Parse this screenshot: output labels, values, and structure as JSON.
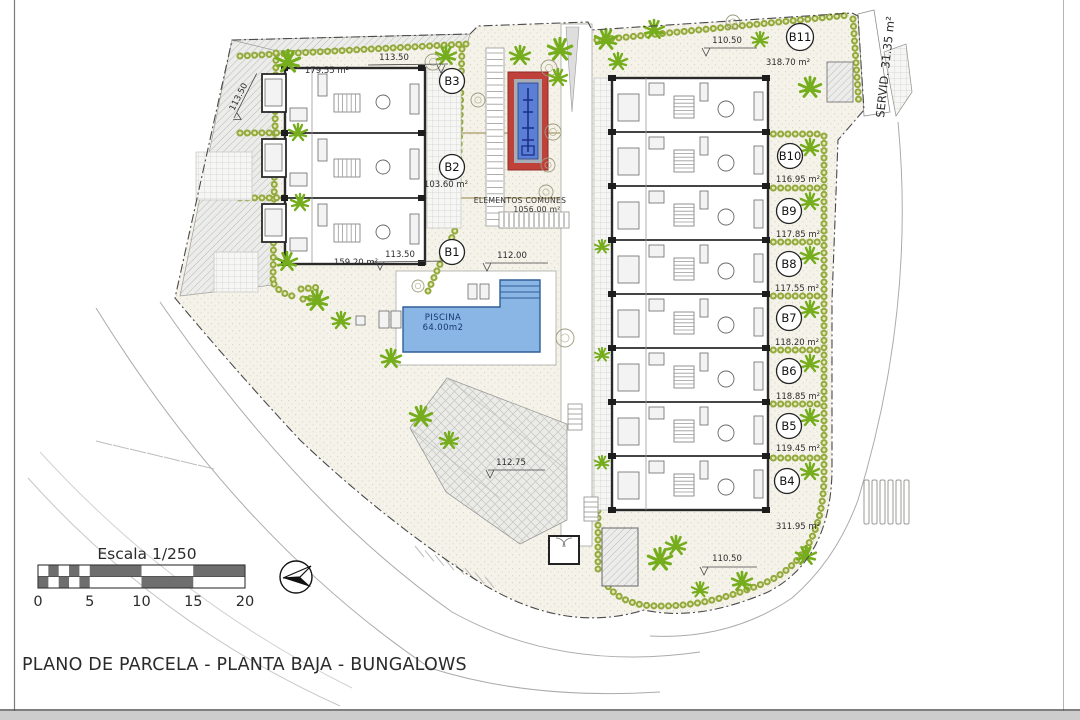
{
  "drawing": {
    "title": "PLANO DE PARCELA - PLANTA BAJA - BUNGALOWS",
    "scale_bar": {
      "label": "Escala 1/250",
      "ticks": [
        "0",
        "5",
        "10",
        "15",
        "20"
      ]
    }
  },
  "site": {
    "servitude_label": "SERVID. 31.35 m²",
    "common_area": {
      "name": "ELEMENTOS COMUNES",
      "value": "1056.00 m²"
    },
    "pool": {
      "name": "PISCINA",
      "value": "64.00m2"
    },
    "units": [
      {
        "id": "B1",
        "area": "159.20 m²"
      },
      {
        "id": "B2",
        "area": "103.60 m²"
      },
      {
        "id": "B3",
        "area": "179.55 m²"
      },
      {
        "id": "B4",
        "area": "311.95 m²"
      },
      {
        "id": "B5",
        "area": "119.45 m²"
      },
      {
        "id": "B6",
        "area": "118.85 m²"
      },
      {
        "id": "B7",
        "area": "118.20 m²"
      },
      {
        "id": "B8",
        "area": "117.55 m²"
      },
      {
        "id": "B9",
        "area": "117.85 m²"
      },
      {
        "id": "B10",
        "area": "116.95 m²"
      },
      {
        "id": "B11",
        "area": "318.70 m²"
      }
    ],
    "dimensions": {
      "west_boundary": "113.50",
      "left_block_top": "113.50",
      "left_block_bottom": "113.50",
      "center_walk": "112.00",
      "plaza": "112.75",
      "right_top": "110.50",
      "right_bottom": "110.50"
    },
    "colors": {
      "palm_green": "#76ad1c",
      "hedge_green": "#93a83d",
      "pool_blue": "#8ab6e6",
      "monument_red": "#c0403a",
      "monument_blue": "#5b7fd4"
    }
  }
}
